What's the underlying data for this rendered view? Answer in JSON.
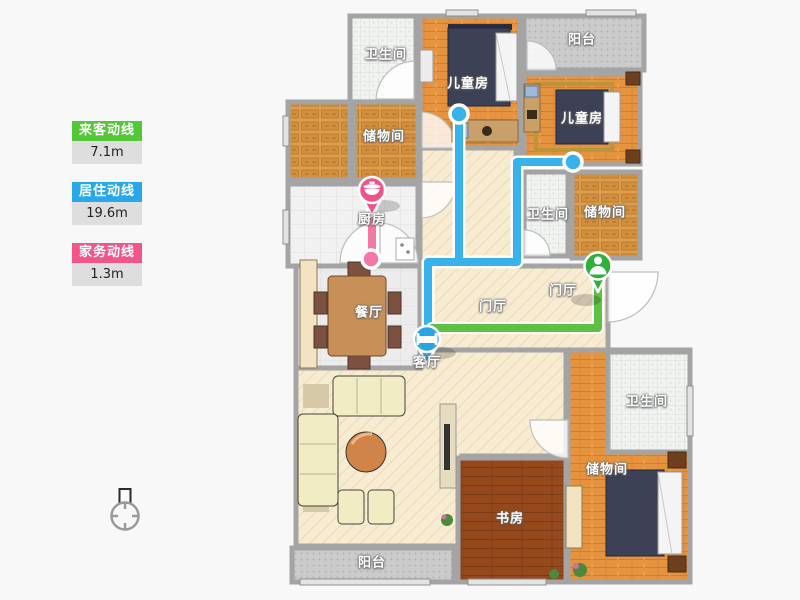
{
  "legend": {
    "items": [
      {
        "label": "来客动线",
        "value": "7.1m",
        "color": "#54c738"
      },
      {
        "label": "居住动线",
        "value": "19.6m",
        "color": "#28a8e8"
      },
      {
        "label": "家务动线",
        "value": "1.3m",
        "color": "#f2548c"
      }
    ]
  },
  "room_labels": [
    "卫生间",
    "阳台",
    "儿童房",
    "儿童房",
    "储物间",
    "厨房",
    "卫生间",
    "储物间",
    "餐厅",
    "门厅",
    "门厅",
    "客厅",
    "卫生间",
    "储物间",
    "书房",
    "阳台"
  ],
  "routes": [
    {
      "name": "visitor-route",
      "color": "#5ec143"
    },
    {
      "name": "resident-route",
      "color": "#38b2ea"
    },
    {
      "name": "household-route",
      "color": "#f478a4"
    }
  ],
  "markers": [
    {
      "name": "kitchen-marker",
      "icon": "pot-icon",
      "color": "#ef5488"
    },
    {
      "name": "living-marker",
      "icon": "bed-icon",
      "color": "#2aa5e4"
    },
    {
      "name": "entry-marker",
      "icon": "person-icon",
      "color": "#2eb03a"
    }
  ],
  "palette": {
    "wall": "#a4a4a4",
    "wood_floor": "#e6933f",
    "study_floor": "#94481c",
    "tile_floor": "#f1f3f1",
    "hall_floor": "#f7ebd1",
    "balcony_floor": "#cbcbcb"
  }
}
